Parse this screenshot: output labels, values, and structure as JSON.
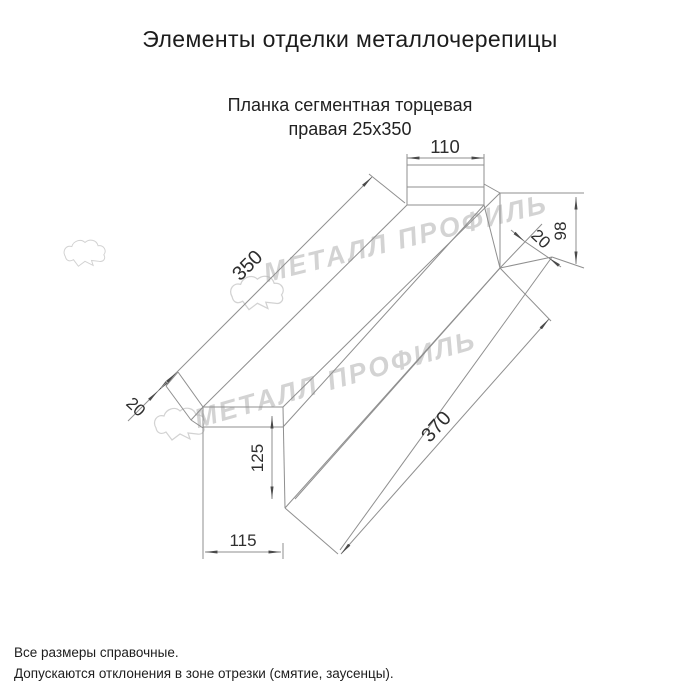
{
  "page": {
    "title": "Элементы отделки металлочерепицы"
  },
  "product": {
    "subtitle_line1": "Планка сегментная торцевая",
    "subtitle_line2": "правая 25х350"
  },
  "dimensions": {
    "top_width": "110",
    "length": "350",
    "right_height": "98",
    "right_fold": "20",
    "left_fold": "20",
    "end_height": "125",
    "end_width": "115",
    "bottom_length": "370"
  },
  "watermark": {
    "text": "МЕТАЛЛ ПРОФИЛЬ",
    "color": "#b9b9b9"
  },
  "footer": {
    "line1": "Все размеры справочные.",
    "line2": "Допускаются отклонения в зоне отрезки (смятие, заусенцы)."
  },
  "colors": {
    "line": "#8f8f8f",
    "dim_text": "#2e2e2e",
    "background": "#ffffff"
  }
}
